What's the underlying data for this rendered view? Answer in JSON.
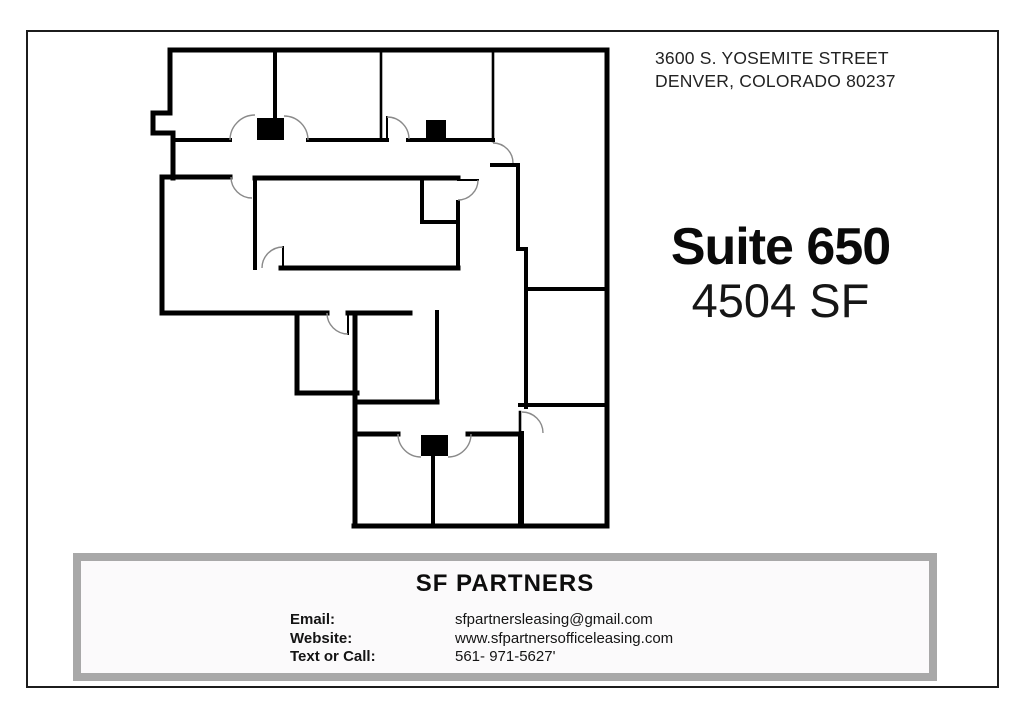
{
  "page": {
    "background": "#ffffff",
    "border_color": "#1c1c1c"
  },
  "address": {
    "line1": "3600 S. YOSEMITE STREET",
    "line2": "DENVER, COLORADO 80237"
  },
  "suite": {
    "title": "Suite 650",
    "area": "4504 SF"
  },
  "floor_plan": {
    "label": "Suite 650 floor plan",
    "wall_color": "#000000",
    "door_arc_color": "#8a8a8a",
    "door_marker_color": "#000000"
  },
  "footer": {
    "company": "SF PARTNERS",
    "frame_color": "#a8a8a8",
    "rows": [
      {
        "label": "Email:",
        "value": "sfpartnersleasing@gmail.com"
      },
      {
        "label": "Website:",
        "value": "www.sfpartnersofficeleasing.com"
      },
      {
        "label": "Text or Call:",
        "value": "561- 971-5627'"
      }
    ]
  }
}
